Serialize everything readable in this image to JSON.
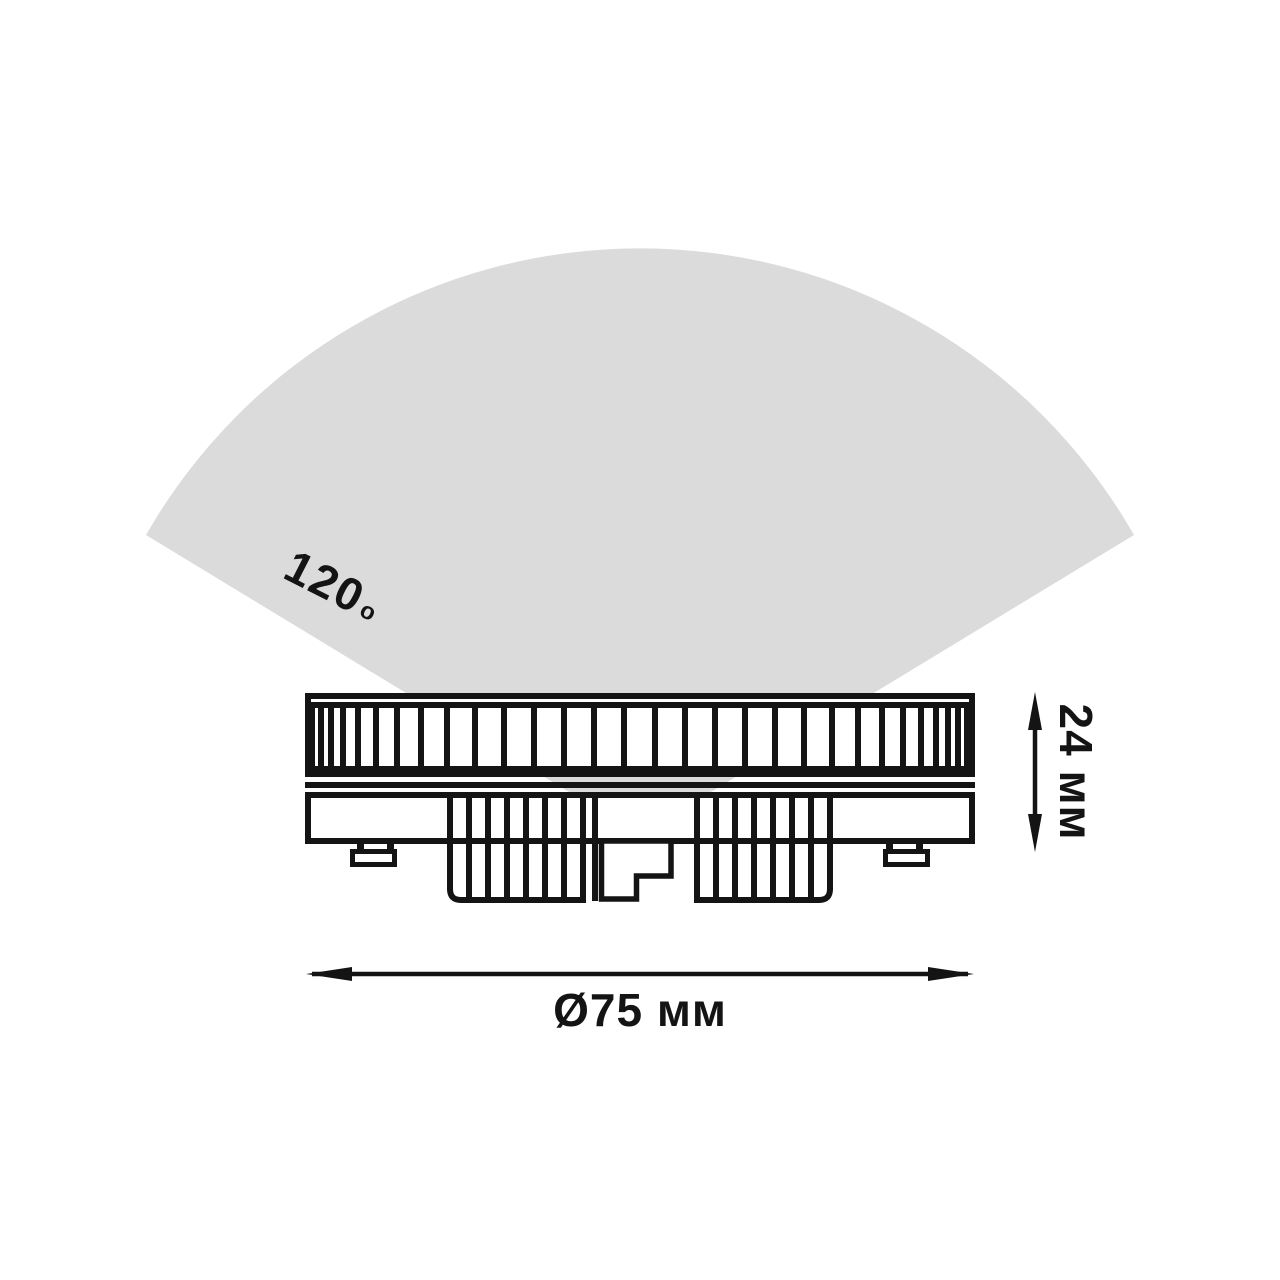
{
  "labels": {
    "beam_angle_value": "120",
    "beam_angle_degree": "o",
    "height": "24 мм",
    "diameter": "Ø75 мм"
  },
  "beam": {
    "angle_deg": 120
  },
  "colors": {
    "background": "#ffffff",
    "beam": "#dbdbdb",
    "line": "#141414"
  }
}
